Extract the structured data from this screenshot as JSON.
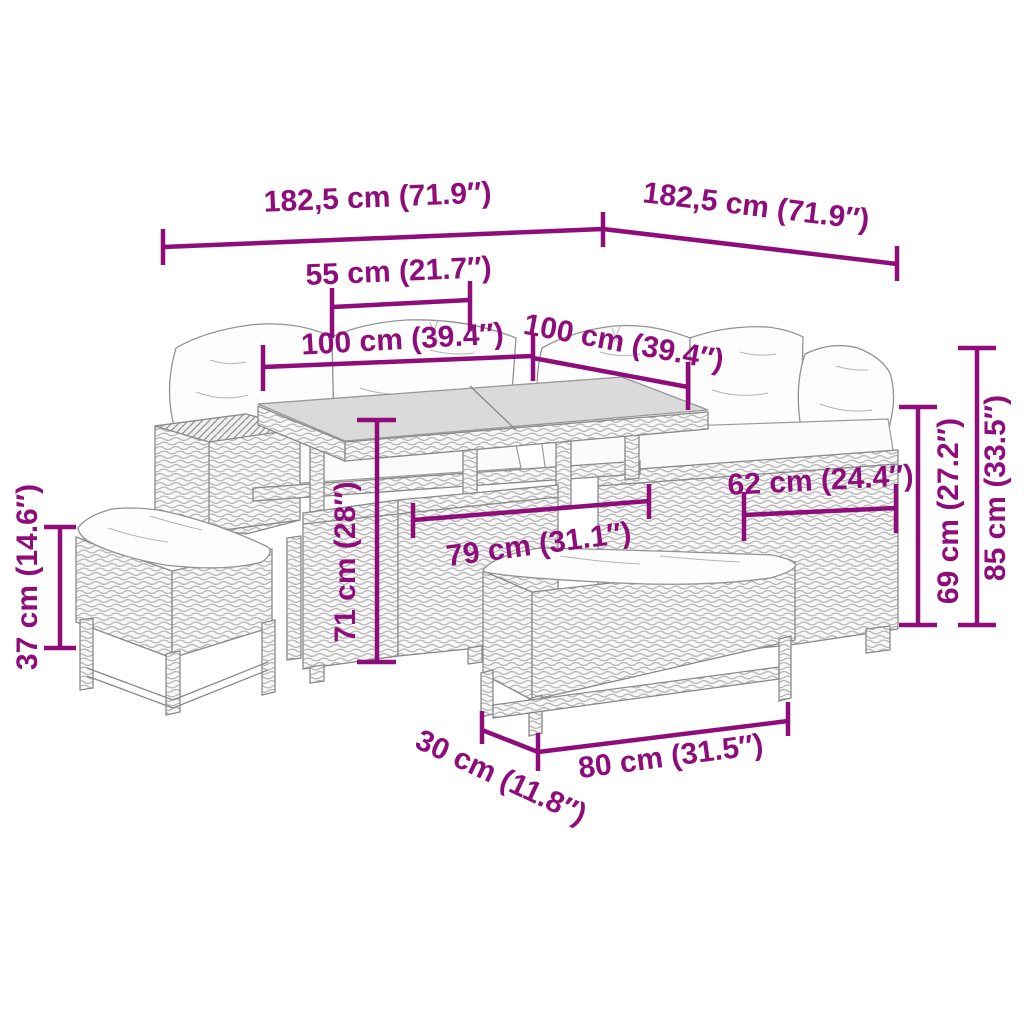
{
  "diagram": {
    "kind": "product-dimension-diagram",
    "background_color": "#FFFFFF",
    "accent_color": "#8E0D7B",
    "line_art_color": "#8A8A8A",
    "glass_fill": "#DADADA",
    "cushion_fill": "#FDFDFD",
    "labels": {
      "total_width_left": "182,5 cm (71.9″)",
      "total_width_right": "182,5 cm (71.9″)",
      "table_inner_55": "55 cm (21.7″)",
      "seat_width_left_100": "100 cm (39.4″)",
      "seat_width_right_100": "100 cm (39.4″)",
      "sofa_depth_62": "62 cm (24.4″)",
      "table_length_79": "79 cm (31.1″)",
      "table_height_71": "71 cm (28″)",
      "stool_height_37": "37 cm (14.6″)",
      "seat_height_69": "69 cm (27.2″)",
      "back_height_85": "85 cm (33.5″)",
      "bench_depth_30": "30 cm (11.8″)",
      "bench_length_80": "80 cm (31.5″)"
    }
  }
}
